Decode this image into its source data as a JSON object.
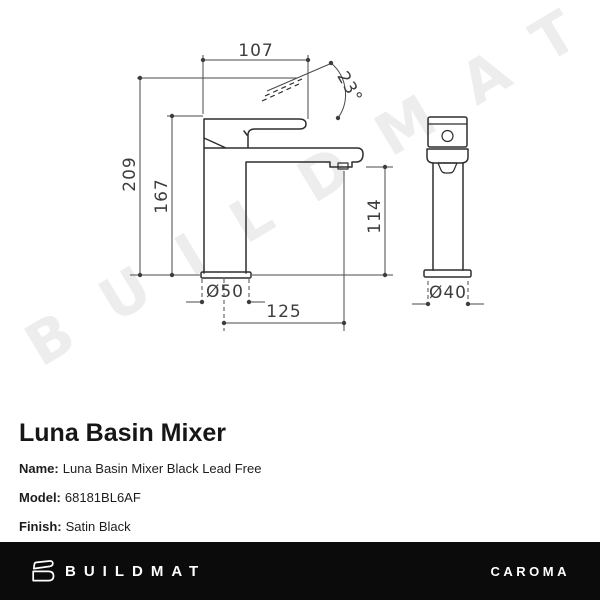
{
  "drawing": {
    "watermark": "BUILDMAT",
    "front_view": {
      "handle_width": "107",
      "handle_angle": "23°",
      "total_height": "209",
      "body_height": "167",
      "outlet_height": "114",
      "spout_reach": "125",
      "base_diameter": "Ø50"
    },
    "side_view": {
      "base_diameter": "Ø40"
    }
  },
  "product": {
    "title": "Luna Basin Mixer",
    "fields": [
      {
        "label": "Name:",
        "value": "Luna Basin Mixer Black Lead Free"
      },
      {
        "label": "Model:",
        "value": "68181BL6AF"
      },
      {
        "label": "Finish:",
        "value": "Satin Black"
      }
    ]
  },
  "footer": {
    "left_brand": "BUILDMAT",
    "right_brand": "CAROMA"
  },
  "colors": {
    "line": "#2e2e2e",
    "dimension": "#4a4a4a",
    "watermark": "#ededed",
    "footer_bar": "#0b0b0b"
  }
}
